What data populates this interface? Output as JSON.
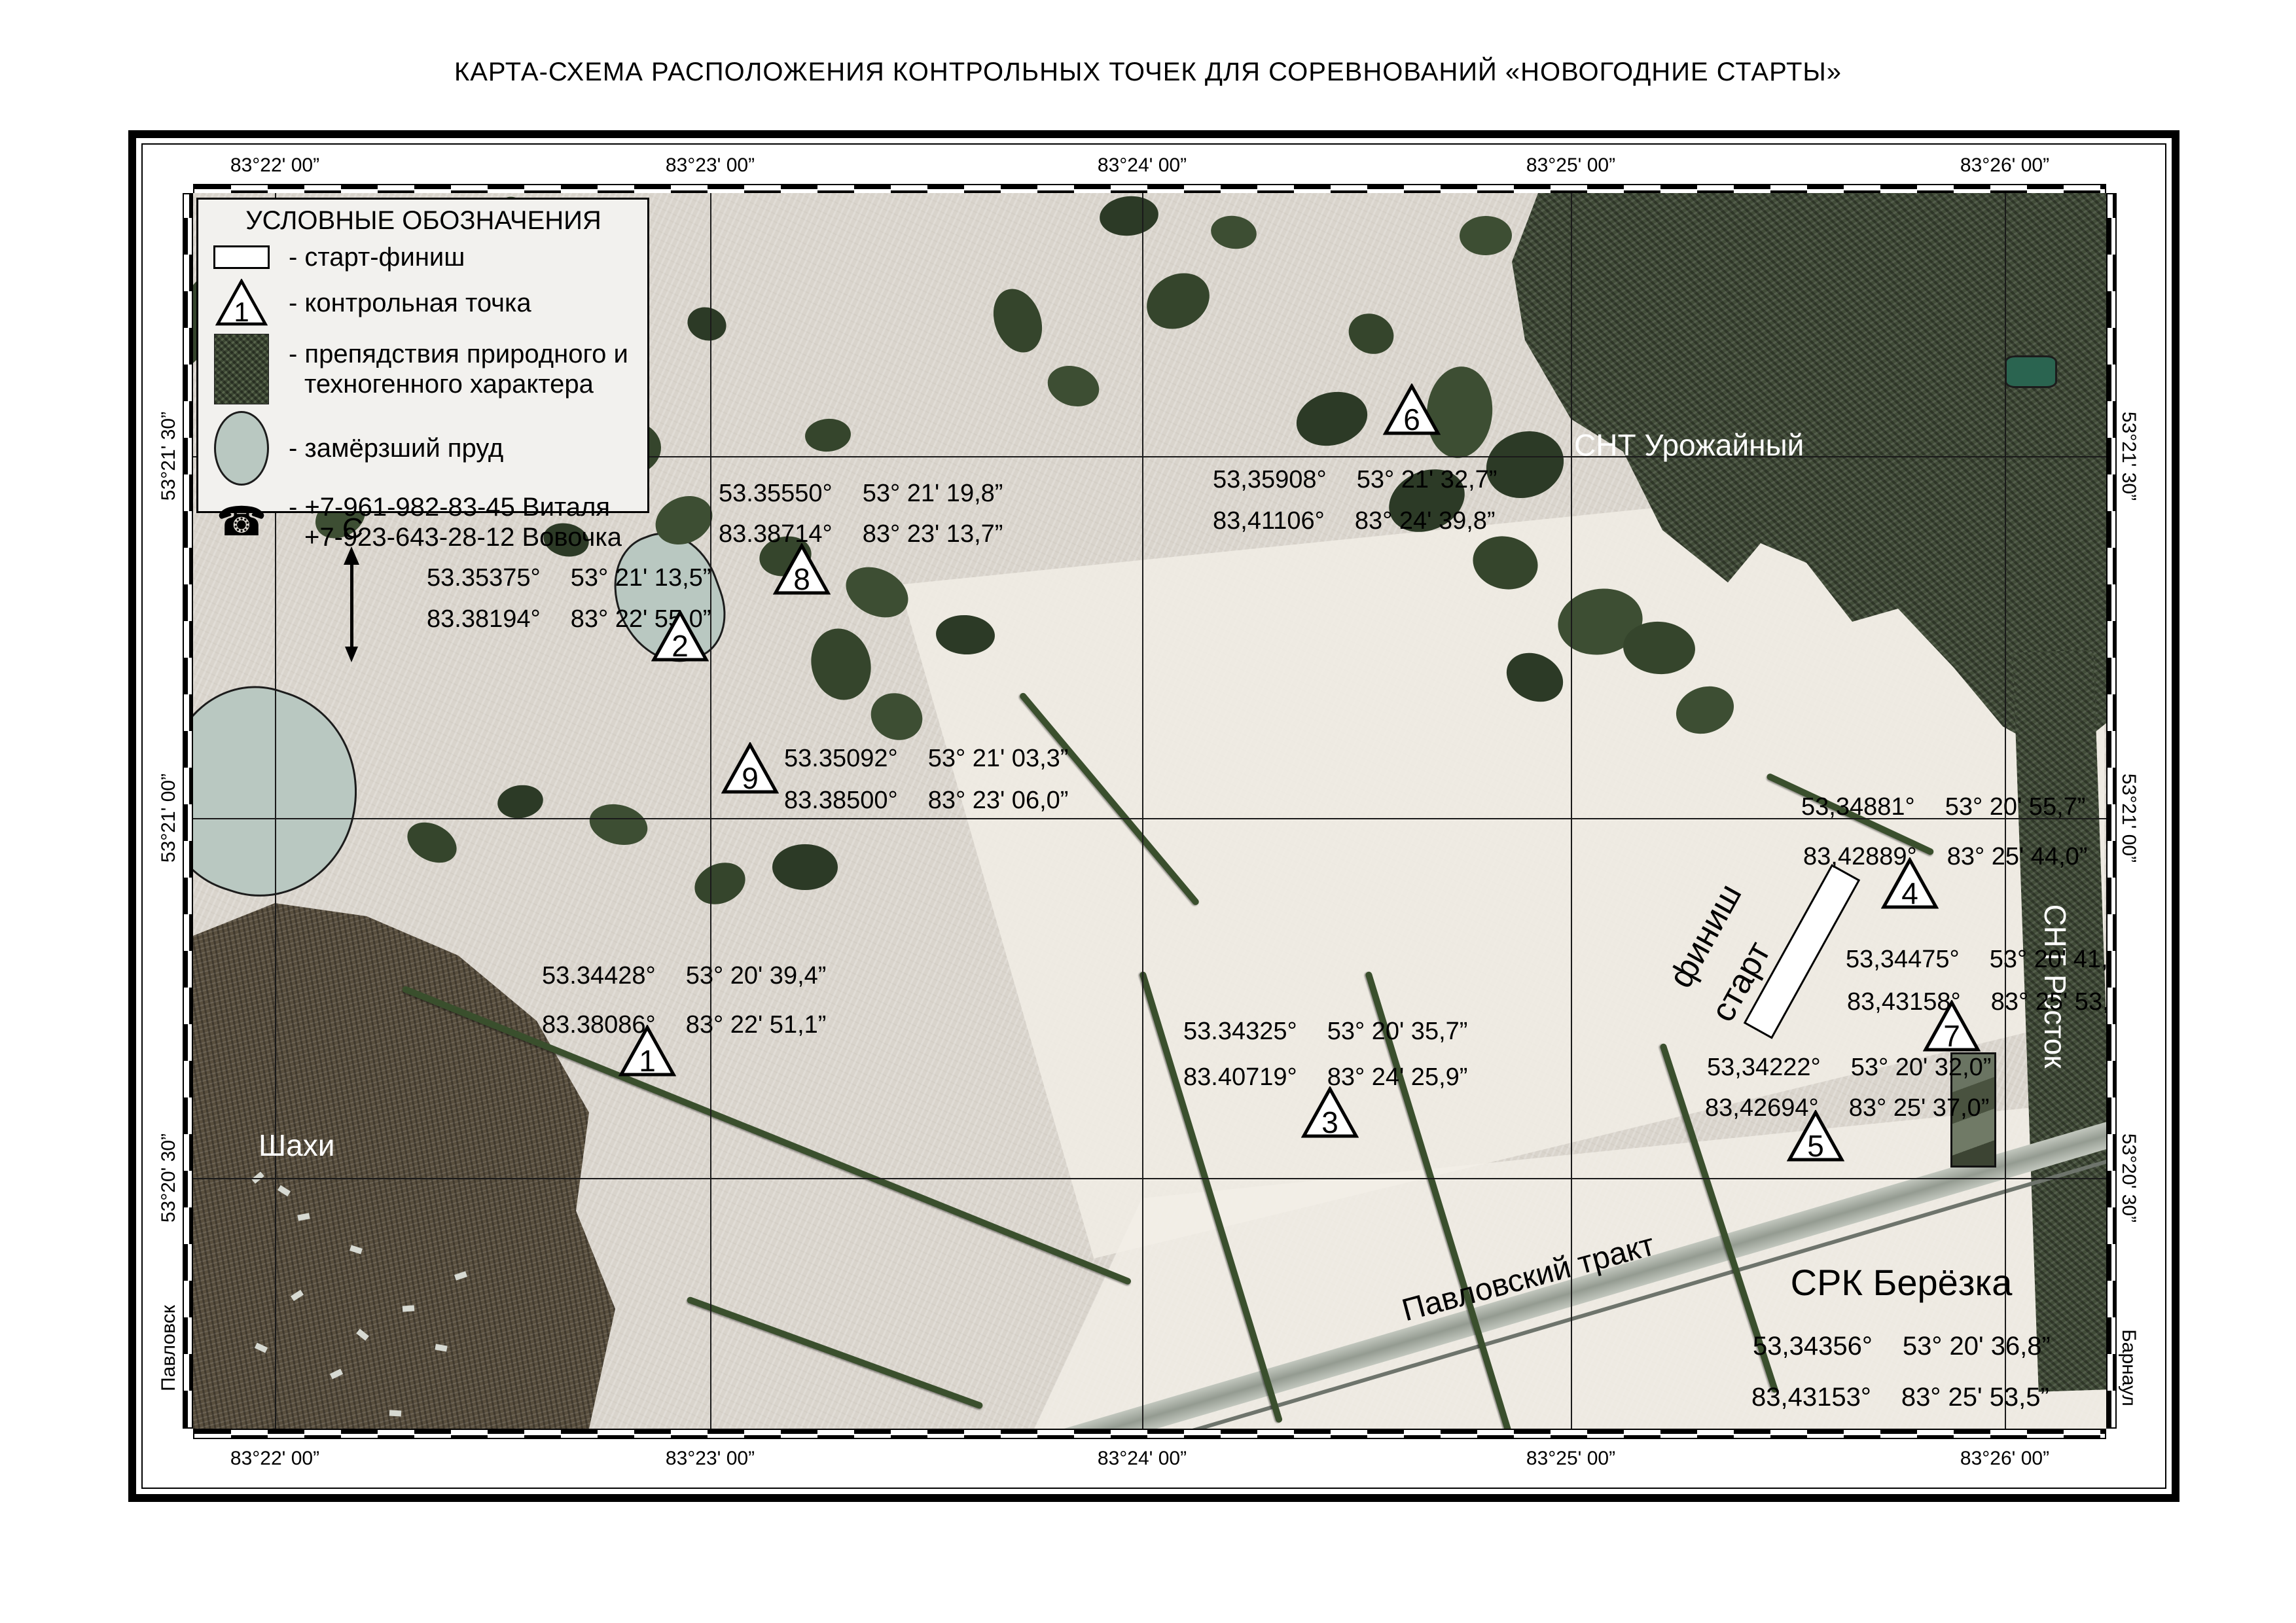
{
  "title": "КАРТА-СХЕМА РАСПОЛОЖЕНИЯ КОНТРОЛЬНЫХ ТОЧЕК ДЛЯ СОРЕВНОВАНИЙ «НОВОГОДНИЕ СТАРТЫ»",
  "legend": {
    "title": "УСЛОВНЫЕ ОБОЗНАЧЕНИЯ",
    "start_finish_label": "- старт-финиш",
    "control_point_label": "- контрольная точка",
    "control_point_symbol_number": "1",
    "obstacles_label_line1": "- препядствия природного и",
    "obstacles_label_line2": "техногенного характера",
    "pond_label": "- замёрзший пруд",
    "phone_icon": "☎",
    "phone_line1": "- +7-961-982-83-45 Виталя",
    "phone_line2": "+7-923-643-28-12 Вовочка"
  },
  "north_letter": "С",
  "grid": {
    "top": [
      "83°22' 00”",
      "83°23' 00”",
      "83°24' 00”",
      "83°25' 00”",
      "83°26' 00”"
    ],
    "bottom": [
      "83°22' 00”",
      "83°23' 00”",
      "83°24' 00”",
      "83°25' 00”",
      "83°26' 00”"
    ],
    "left": [
      "53°21' 30”",
      "53°21' 00”",
      "53°20' 30”"
    ],
    "right": [
      "53°21' 30”",
      "53°21' 00”",
      "53°20' 30”"
    ],
    "left_place": "Павловск",
    "right_place": "Барнаул"
  },
  "points": [
    {
      "n": "1",
      "dec_lat": "53.34428°",
      "dms_lat": "53° 20' 39,4”",
      "dec_lon": "83.38086°",
      "dms_lon": "83° 22' 51,1”"
    },
    {
      "n": "2",
      "dec_lat": "53.35375°",
      "dms_lat": "53° 21' 13,5”",
      "dec_lon": "83.38194°",
      "dms_lon": "83° 22' 55,0”"
    },
    {
      "n": "3",
      "dec_lat": "53.34325°",
      "dms_lat": "53° 20' 35,7”",
      "dec_lon": "83.40719°",
      "dms_lon": "83° 24' 25,9”"
    },
    {
      "n": "4",
      "dec_lat": "53,34881°",
      "dms_lat": "53° 20' 55,7”",
      "dec_lon": "83,42889°",
      "dms_lon": "83° 25' 44,0”"
    },
    {
      "n": "5",
      "dec_lat": "53,34222°",
      "dms_lat": "53° 20' 32,0”",
      "dec_lon": "83,42694°",
      "dms_lon": "83° 25' 37,0”"
    },
    {
      "n": "6",
      "dec_lat": "53,35908°",
      "dms_lat": "53° 21' 32,7”",
      "dec_lon": "83,41106°",
      "dms_lon": "83° 24' 39,8”"
    },
    {
      "n": "7",
      "dec_lat": "53,34475°",
      "dms_lat": "53° 20' 41,1”",
      "dec_lon": "83,43158°",
      "dms_lon": "83° 25' 53,7”"
    },
    {
      "n": "8",
      "dec_lat": "53.35550°",
      "dms_lat": "53° 21' 19,8”",
      "dec_lon": "83.38714°",
      "dms_lon": "83° 23' 13,7”"
    },
    {
      "n": "9",
      "dec_lat": "53.35092°",
      "dms_lat": "53° 21' 03,3”",
      "dec_lon": "83.38500°",
      "dms_lon": "83° 23' 06,0”"
    }
  ],
  "places": {
    "snt_urozhayny": "СНТ Урожайный",
    "shahi": "Шахи",
    "snt_rostok": "СНТ Росток",
    "road": "Павловский тракт",
    "finish": "финиш",
    "start": "старт"
  },
  "srk": {
    "name": "СРК Берёзка",
    "dec_lat": "53,34356°",
    "dms_lat": "53° 20' 36,8”",
    "dec_lon": "83,43153°",
    "dms_lon": "83° 25' 53,5”"
  }
}
